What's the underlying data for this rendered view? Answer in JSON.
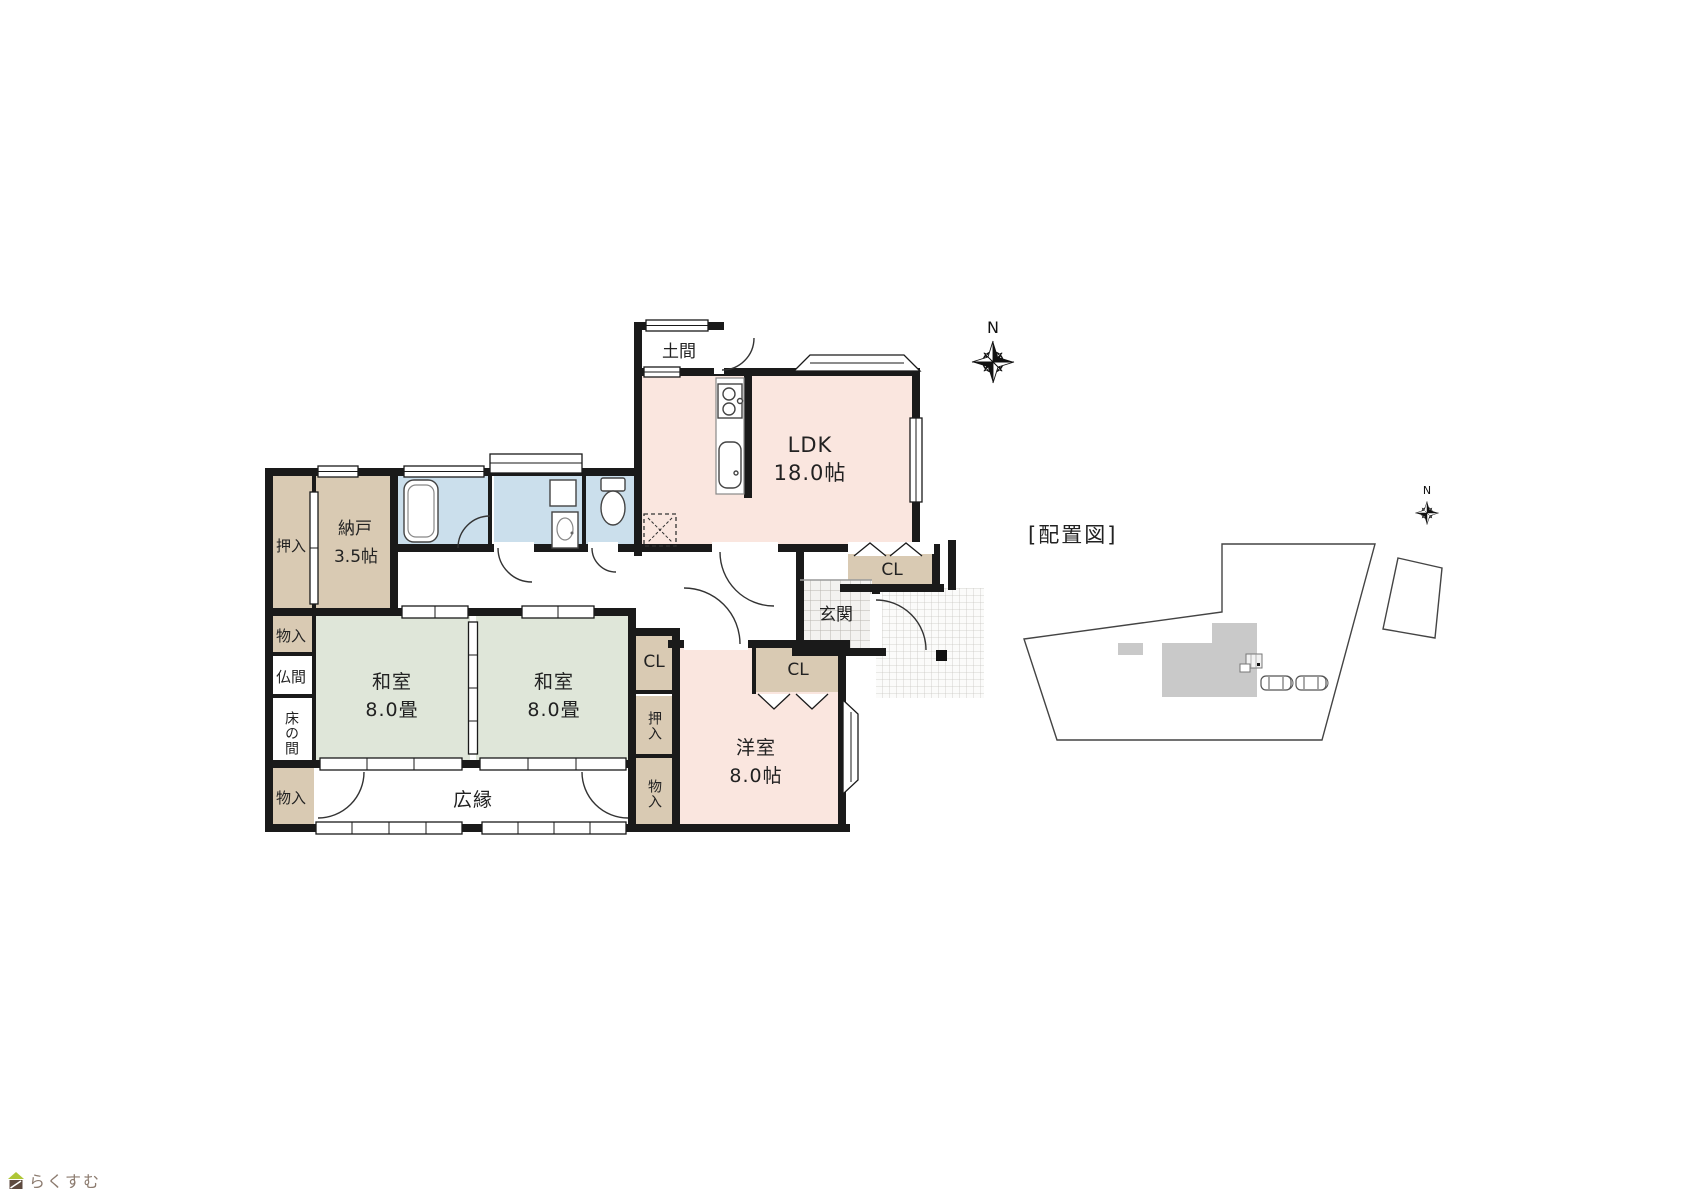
{
  "floor_plan": {
    "compass": {
      "north_label": "N"
    },
    "rooms": {
      "doma": {
        "label": "土間"
      },
      "ldk": {
        "label": "LDK",
        "size": "18.0帖"
      },
      "nando": {
        "label": "納戸",
        "size": "3.5帖"
      },
      "oshiire_nw": {
        "label": "押入"
      },
      "monoire_w_top": {
        "label": "物入"
      },
      "butsuma": {
        "label": "仏間"
      },
      "tokonoma": {
        "label": "床の間"
      },
      "monoire_w_bottom": {
        "label": "物入"
      },
      "washitsu_left": {
        "label": "和室",
        "size": "8.0畳"
      },
      "washitsu_right": {
        "label": "和室",
        "size": "8.0畳"
      },
      "hiroen": {
        "label": "広縁"
      },
      "genkan": {
        "label": "玄関"
      },
      "closet_entry": {
        "label": "CL"
      },
      "closet_hall": {
        "label": "CL"
      },
      "oshiire_east": {
        "label": "押入"
      },
      "monoire_east": {
        "label": "物入"
      },
      "closet_yoshitsu": {
        "label": "CL"
      },
      "yoshitsu": {
        "label": "洋室",
        "size": "8.0帖"
      }
    }
  },
  "site_plan": {
    "title": "[配置図]",
    "compass": {
      "north_label": "N"
    }
  },
  "branding": {
    "logo_text": "らくすむ"
  },
  "colors": {
    "wall": "#1a1a1a",
    "room_pink": "#fae6df",
    "room_green": "#dfe6d9",
    "room_beige": "#d9cab3",
    "room_blue": "#cbdfec",
    "room_white": "#ffffff",
    "site_building_gray": "#c9c9c9",
    "logo_green": "#aec636",
    "logo_brown": "#5d4a3f",
    "logo_text_color": "#8c7b6f"
  }
}
